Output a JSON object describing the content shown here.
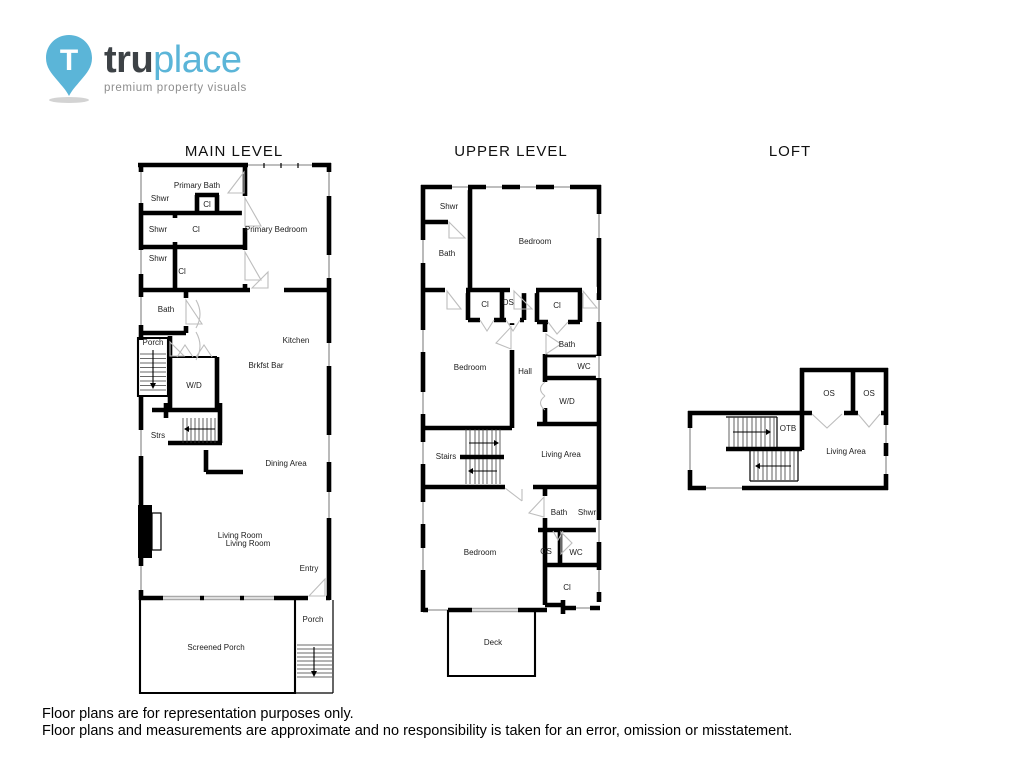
{
  "logo": {
    "brand_bold": "tru",
    "brand_light": "place",
    "tagline": "premium property visuals",
    "pin_letter": "T",
    "brand_color": "#5bb5d8",
    "text_color": "#3d4246"
  },
  "colors": {
    "walls": "#000000",
    "windows": "#a9a9a9"
  },
  "levels": [
    {
      "title": "MAIN LEVEL",
      "rooms": [
        "Primary Bath",
        "Shwr",
        "Cl",
        "Shwr",
        "Cl",
        "Shwr",
        "Cl",
        "Primary Bedroom",
        "Bath",
        "Porch",
        "W/D",
        "Kitchen",
        "Brkfst Bar",
        "Strs",
        "Dining Area",
        "Living Room",
        "Living Room",
        "Entry",
        "Porch",
        "Screened Porch"
      ]
    },
    {
      "title": "UPPER LEVEL",
      "rooms": [
        "Shwr",
        "Bath",
        "Bedroom",
        "Cl",
        "OS",
        "Cl",
        "Bedroom",
        "Hall",
        "Bath",
        "WC",
        "W/D",
        "Stairs",
        "Living Area",
        "Bath",
        "Shwr",
        "Bedroom",
        "OS",
        "WC",
        "Cl",
        "Deck"
      ]
    },
    {
      "title": "LOFT",
      "rooms": [
        "OS",
        "OS",
        "OTB",
        "Living Area"
      ]
    }
  ],
  "footer": {
    "line1": "Floor plans are for representation purposes only.",
    "line2": "Floor plans and measurements are approximate and no responsibility is taken for an error, omission or misstatement."
  }
}
